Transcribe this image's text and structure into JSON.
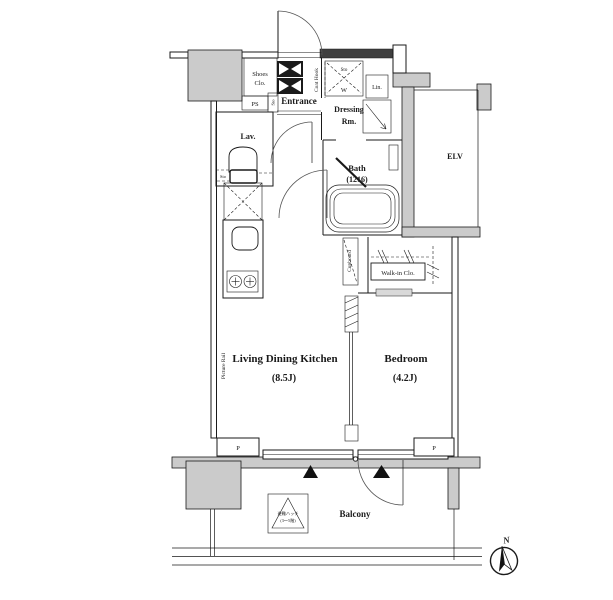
{
  "title": "Apartment floor plan (1K/1LDK unit)",
  "colors": {
    "background": "#ffffff",
    "wall_fill_gray": "#cbcbcb",
    "wall_fill_dark": "#3f3f3f",
    "line_color": "#1a1a1a"
  },
  "labels": {
    "entrance": "Entrance",
    "shoes_closet_line1": "Shoes",
    "shoes_closet_line2": "Clo.",
    "ps": "PS",
    "sto_entrance": "Sto",
    "coat_hook": "Coat Hook",
    "dressing_room_line1": "Dressing",
    "dressing_room_line2": "Rm.",
    "sto_washer": "Sto",
    "washer": "W",
    "linen": "Lin.",
    "lavatory": "Lav.",
    "sto_lavatory": "Sto",
    "bath_line1": "Bath",
    "bath_line2": "(1216)",
    "elevator": "ELV",
    "cupboard": "Cupboard",
    "walk_in_closet": "Walk-in Clo.",
    "ldk_name": "Living Dining Kitchen",
    "ldk_size": "(8.5J)",
    "bedroom_name": "Bedroom",
    "bedroom_size": "(4.2J)",
    "picture_rail": "Picture Rail",
    "pipe_left": "P",
    "pipe_right": "P",
    "balcony": "Balcony",
    "hatch_line1": "避難ハッチ",
    "hatch_line2": "(3〜5階)",
    "compass_north": "N"
  }
}
